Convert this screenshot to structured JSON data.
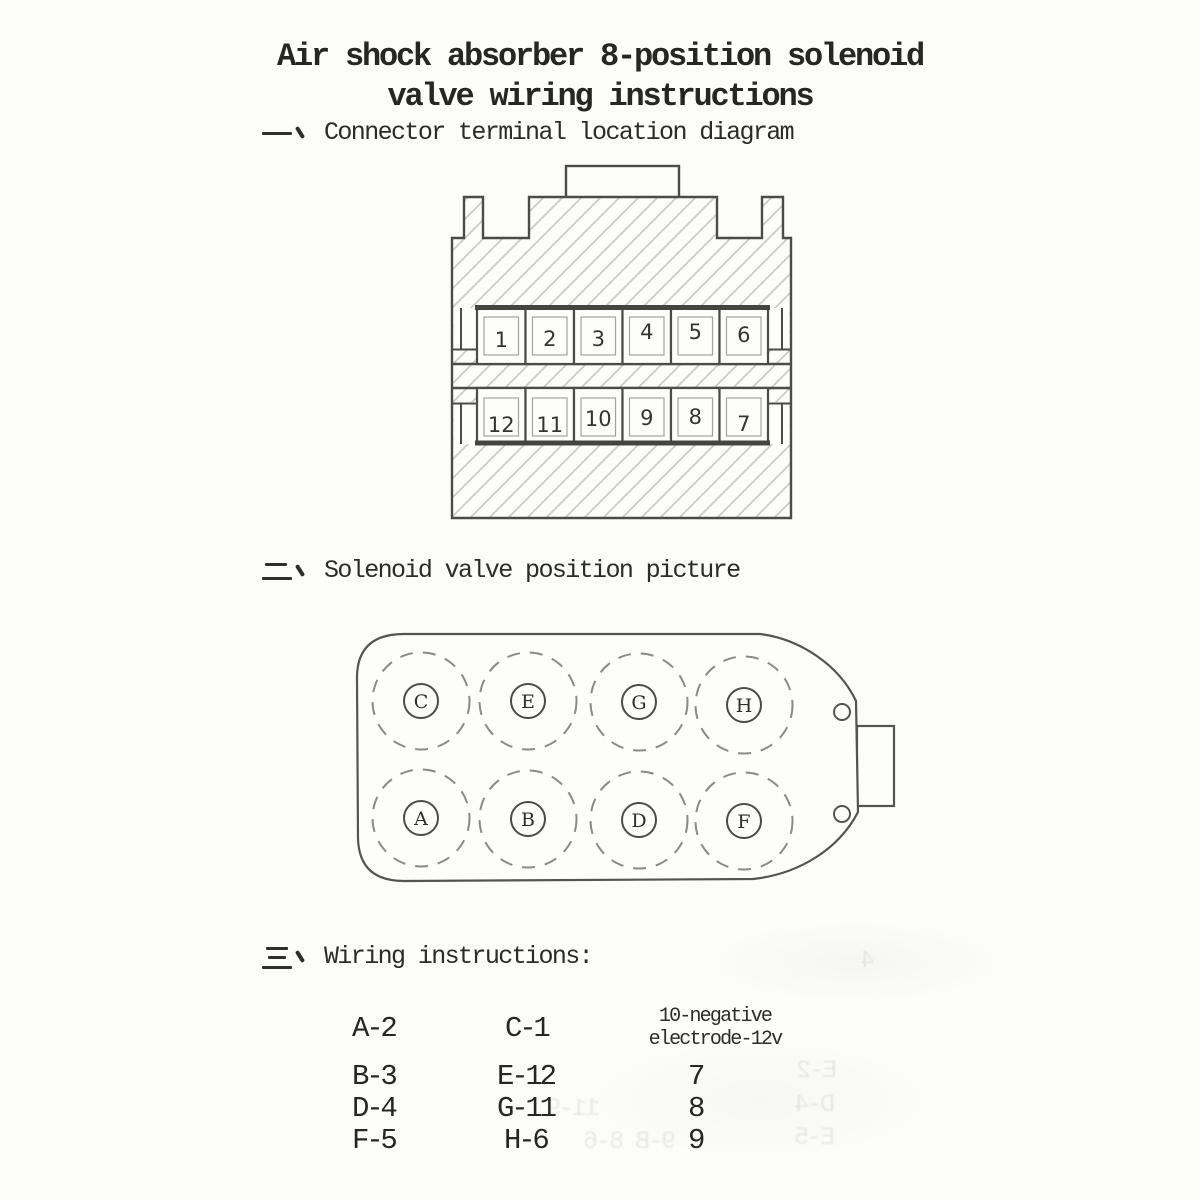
{
  "title": {
    "line1": "Air shock absorber 8-position solenoid",
    "line2": "valve wiring instructions"
  },
  "sections": {
    "one": {
      "marker": "一、",
      "title": "Connector terminal location diagram"
    },
    "two": {
      "marker": "二、",
      "title": "Solenoid valve position picture"
    },
    "three": {
      "marker": "三、",
      "title": "Wiring instructions:"
    }
  },
  "connector": {
    "top_row": [
      "1",
      "2",
      "3",
      "4",
      "5",
      "6"
    ],
    "bottom_row": [
      "12",
      "11",
      "10",
      "9",
      "8",
      "7"
    ]
  },
  "valve": {
    "top_row": [
      "C",
      "E",
      "G",
      "H"
    ],
    "bottom_row": [
      "A",
      "B",
      "D",
      "F"
    ]
  },
  "wiring": {
    "col1": [
      "A-2",
      "B-3",
      "D-4",
      "F-5"
    ],
    "col2": [
      "C-1",
      "E-12",
      "G-11",
      "H-6"
    ],
    "col3_header": [
      "10-negative",
      "electrode-12v"
    ],
    "col3": [
      "7",
      "8",
      "9"
    ]
  },
  "ghost_text": [
    {
      "text": "4",
      "x": 862,
      "y": 946
    },
    {
      "text": "E-2",
      "x": 798,
      "y": 1056
    },
    {
      "text": "D-4",
      "x": 796,
      "y": 1090
    },
    {
      "text": "E-5",
      "x": 796,
      "y": 1123
    },
    {
      "text": "11-9",
      "x": 548,
      "y": 1094
    },
    {
      "text": "9-B 8-6",
      "x": 585,
      "y": 1127
    }
  ],
  "colors": {
    "ink": "#2d2d2a",
    "outline": "#4b4b48",
    "hatch": "#cccbc6",
    "dashed": "#8b8b86",
    "inner_rect": "#a3a39e",
    "paper": "#fcfcfb"
  }
}
